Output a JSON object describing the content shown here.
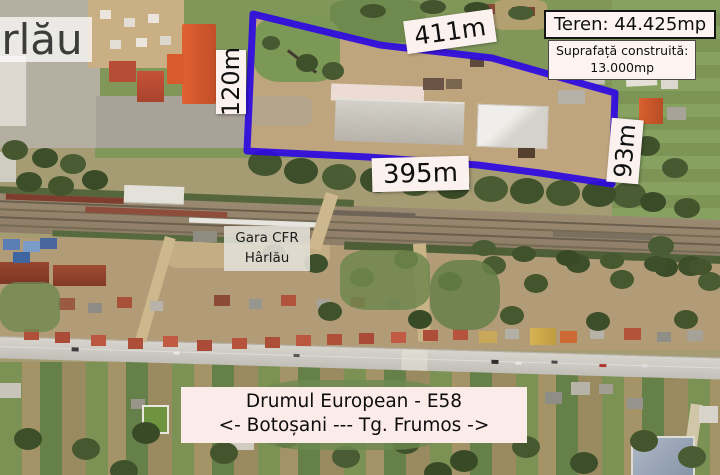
{
  "annotations": {
    "town_label": "Hârlău",
    "dim_top": "411m",
    "dim_left": "120m",
    "dim_bottom": "395m",
    "dim_right": "93m",
    "info_area": "Teren: 44.425mp",
    "info_built_line1": "Suprafață construită:",
    "info_built_line2": "13.000mp",
    "station_line1": "Gara CFR",
    "station_line2": "Hârlău",
    "road_line1": "Drumul European - E58",
    "road_line2": "<- Botoșani --- Tg. Frumos ->"
  },
  "colors": {
    "parcel_outline": "#2e09e2",
    "annotation_label_bg": "#fbf2ef",
    "info_box_bg": "#fdf4f2",
    "road_label_bg": "#fbebe9",
    "station_label_bg": "#e2dfd6"
  }
}
